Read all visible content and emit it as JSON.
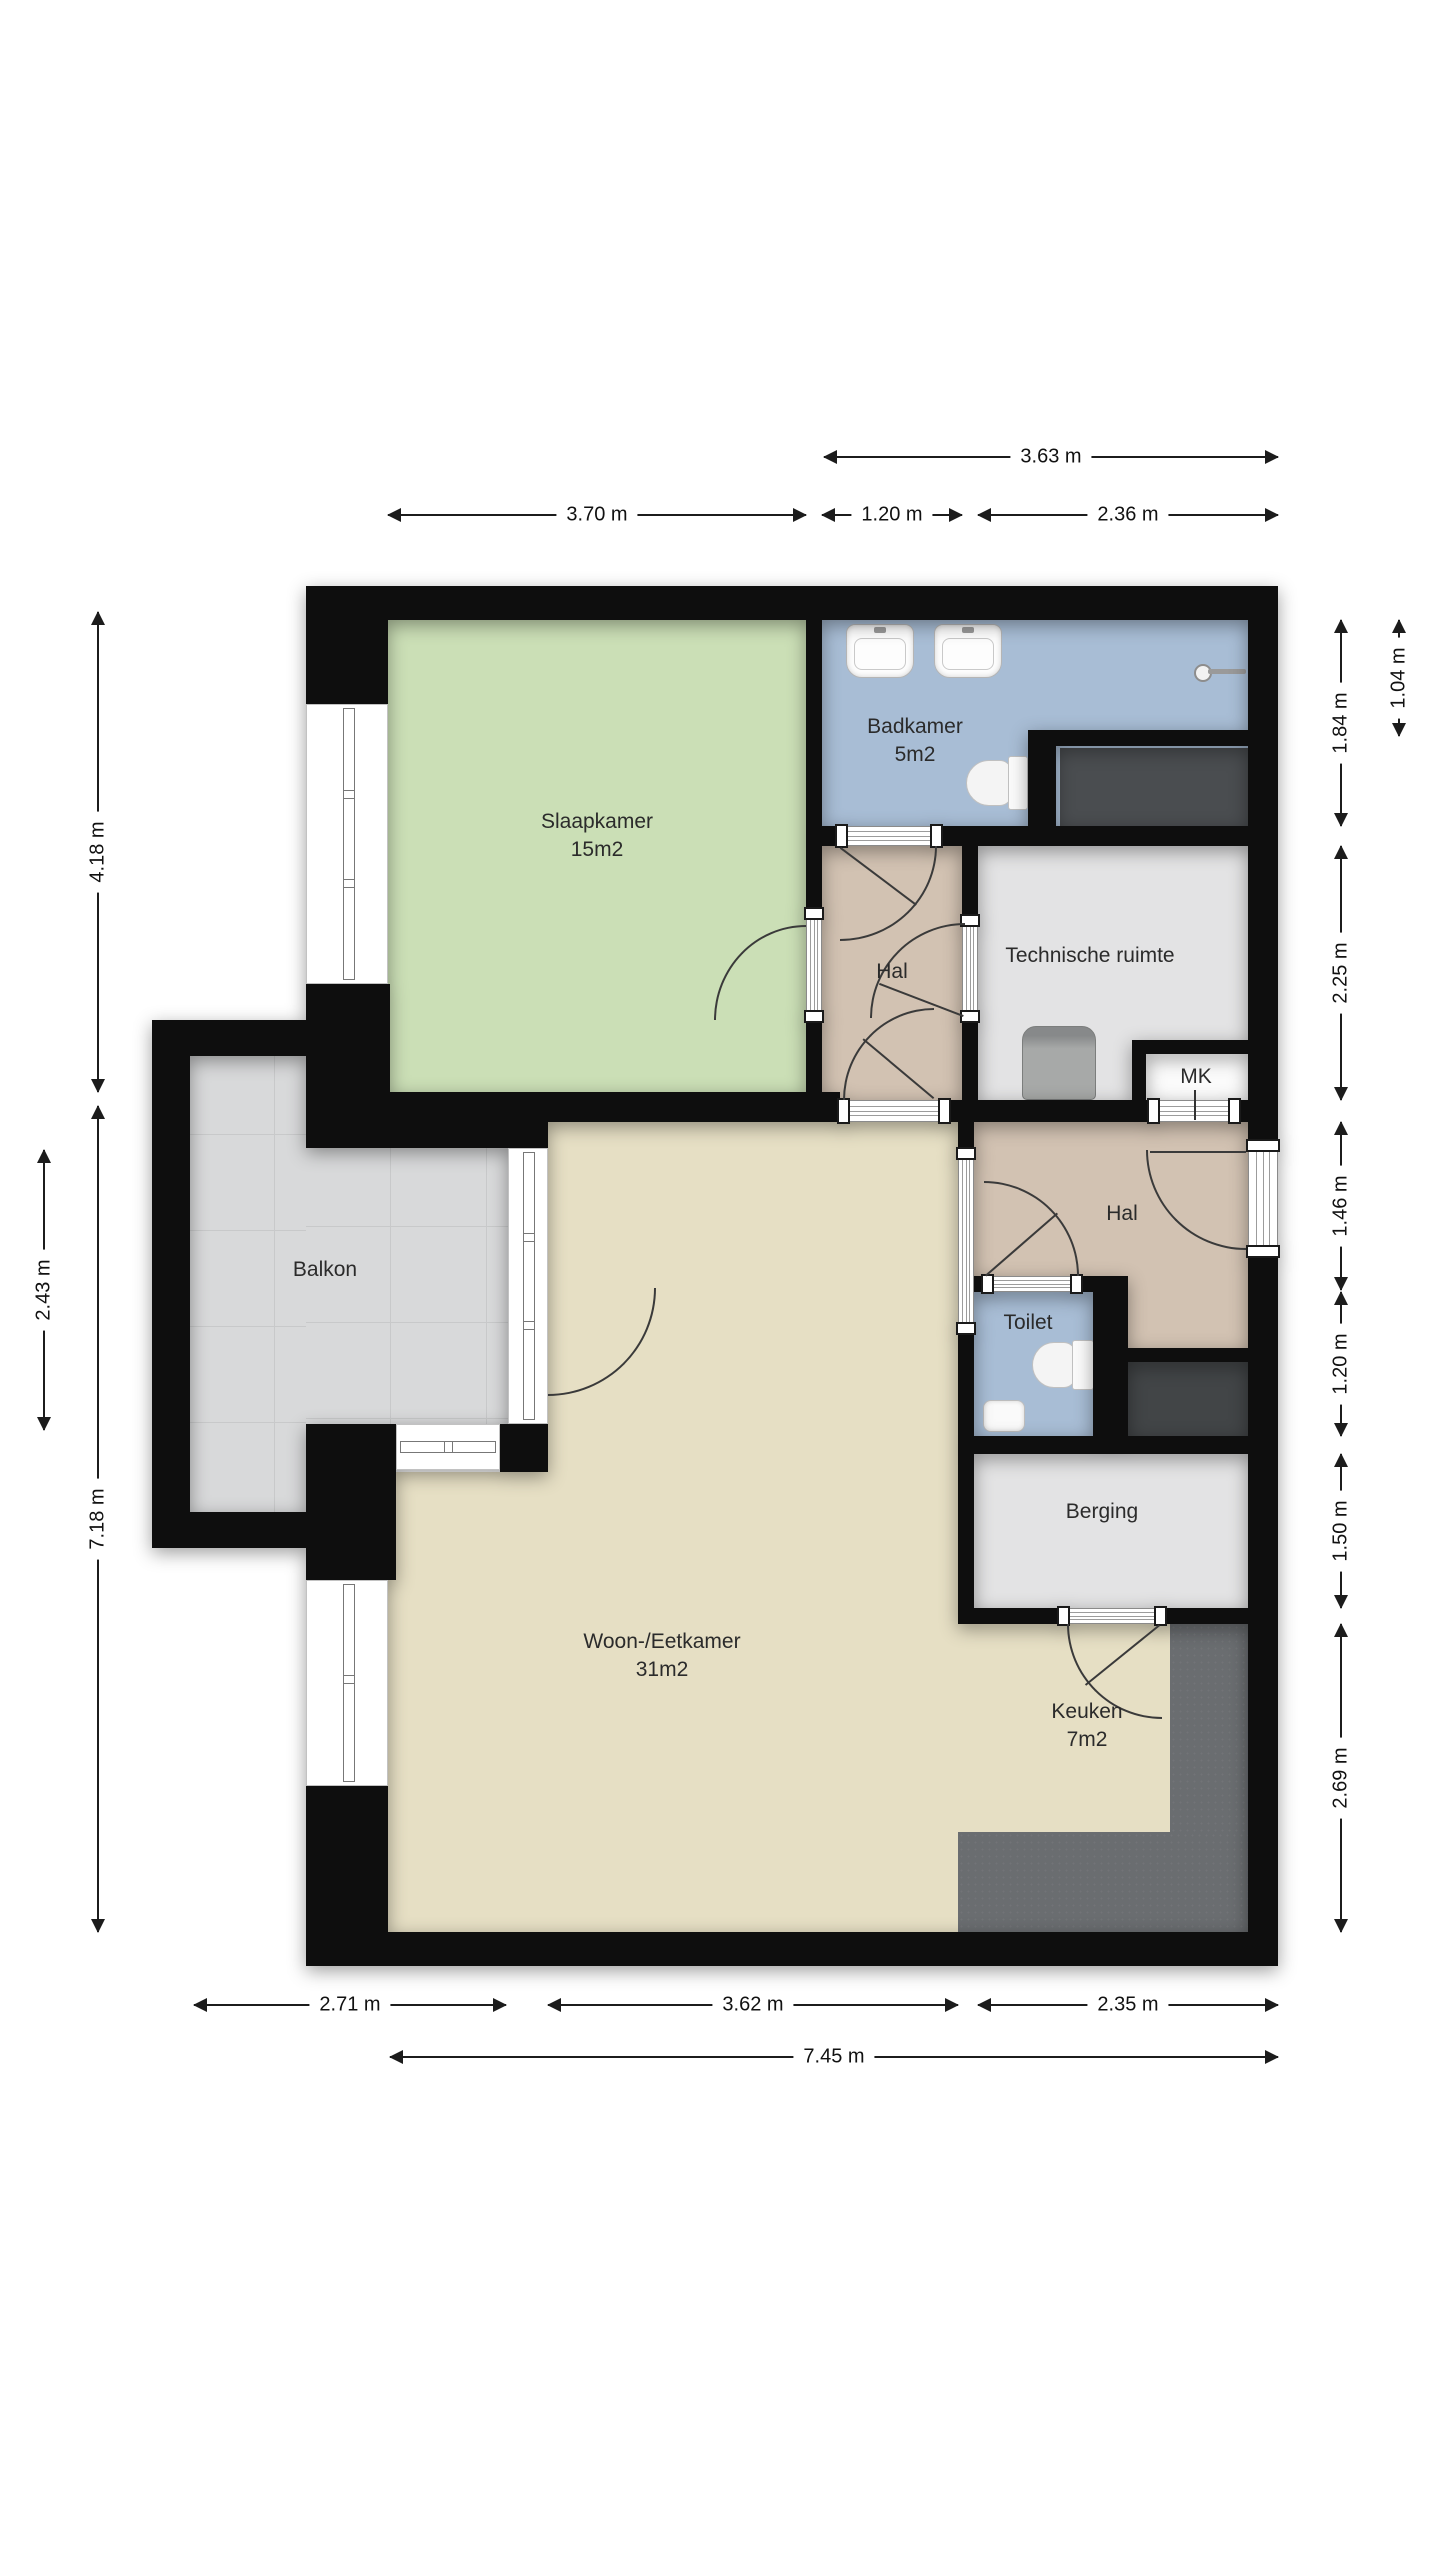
{
  "floorplan": {
    "rooms": {
      "slaapkamer": {
        "label": "Slaapkamer",
        "area": "15m2"
      },
      "badkamer": {
        "label": "Badkamer",
        "area": "5m2"
      },
      "hal_boven": {
        "label": "Hal"
      },
      "technische_ruimte": {
        "label": "Technische ruimte"
      },
      "mk": {
        "label": "MK"
      },
      "hal": {
        "label": "Hal"
      },
      "toilet": {
        "label": "Toilet"
      },
      "berging": {
        "label": "Berging"
      },
      "balkon": {
        "label": "Balkon"
      },
      "woon_eetkamer": {
        "label": "Woon-/Eetkamer",
        "area": "31m2"
      },
      "keuken": {
        "label": "Keuken",
        "area": "7m2"
      }
    },
    "dimensions": {
      "top": [
        {
          "value": "3.63 m"
        },
        {
          "value": "3.70 m"
        },
        {
          "value": "1.20 m"
        },
        {
          "value": "2.36 m"
        }
      ],
      "left": [
        {
          "value": "4.18 m"
        },
        {
          "value": "2.43 m"
        },
        {
          "value": "7.18 m"
        }
      ],
      "right": [
        {
          "value": "1.04 m"
        },
        {
          "value": "1.84 m"
        },
        {
          "value": "2.25 m"
        },
        {
          "value": "1.46 m"
        },
        {
          "value": "1.20 m"
        },
        {
          "value": "1.50 m"
        },
        {
          "value": "2.69 m"
        }
      ],
      "bottom": [
        {
          "value": "2.71 m"
        },
        {
          "value": "3.62 m"
        },
        {
          "value": "2.35 m"
        },
        {
          "value": "7.45 m"
        }
      ]
    },
    "fixtures": [
      "sink",
      "sink",
      "shower",
      "toilet",
      "washing-area",
      "boiler",
      "shaft",
      "toilet",
      "hand-basin",
      "kitchen-counter"
    ],
    "colors": {
      "wall": "#0e0e0e",
      "slaapkamer": "#cbdfb6",
      "badkamer": "#a8bdd5",
      "hal": "#d2c2b2",
      "woonkamer": "#e6dfc4",
      "utility": "#e3e3e4",
      "balkon": "#d8d9da",
      "counter": "#6a6d70",
      "shaft": "#424547",
      "dimension_text": "#111111"
    }
  }
}
